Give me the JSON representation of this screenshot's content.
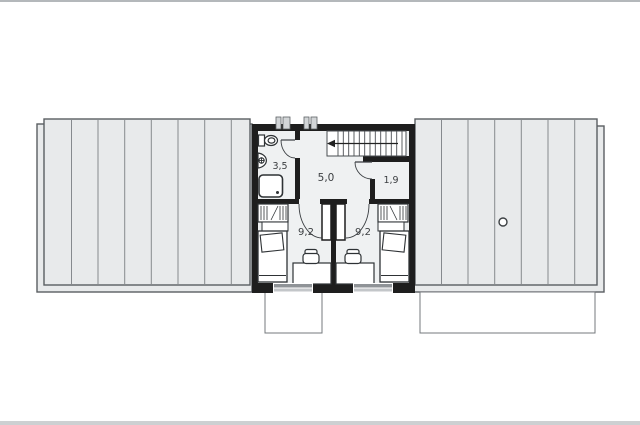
{
  "page": {
    "kind": "floor-plan-drawing",
    "background": "#ffffff",
    "top_border_color": "#b4b8bb",
    "bottom_border_color": "#cdd0d2"
  },
  "floor_plan": {
    "rooms": [
      {
        "id": "bathroom",
        "area_label": "3,5"
      },
      {
        "id": "hall",
        "area_label": "5,0"
      },
      {
        "id": "closet",
        "area_label": "1,9"
      },
      {
        "id": "bedroom-left",
        "area_label": "9,2"
      },
      {
        "id": "bedroom-right",
        "area_label": "9,2"
      }
    ],
    "colors": {
      "wall": "#1e1e1e",
      "roof_fill": "#e8eaeb",
      "roof_panel_line": "#868a8e",
      "roof_border": "#5a5e62",
      "floor_fill": "#eff1f2",
      "fixture_stroke": "#2e3235",
      "door_arc": "#3a3e42",
      "window_gray_dark": "#8f9397",
      "window_gray_light": "#c3c6c9",
      "label_color": "#3b3e41"
    }
  }
}
